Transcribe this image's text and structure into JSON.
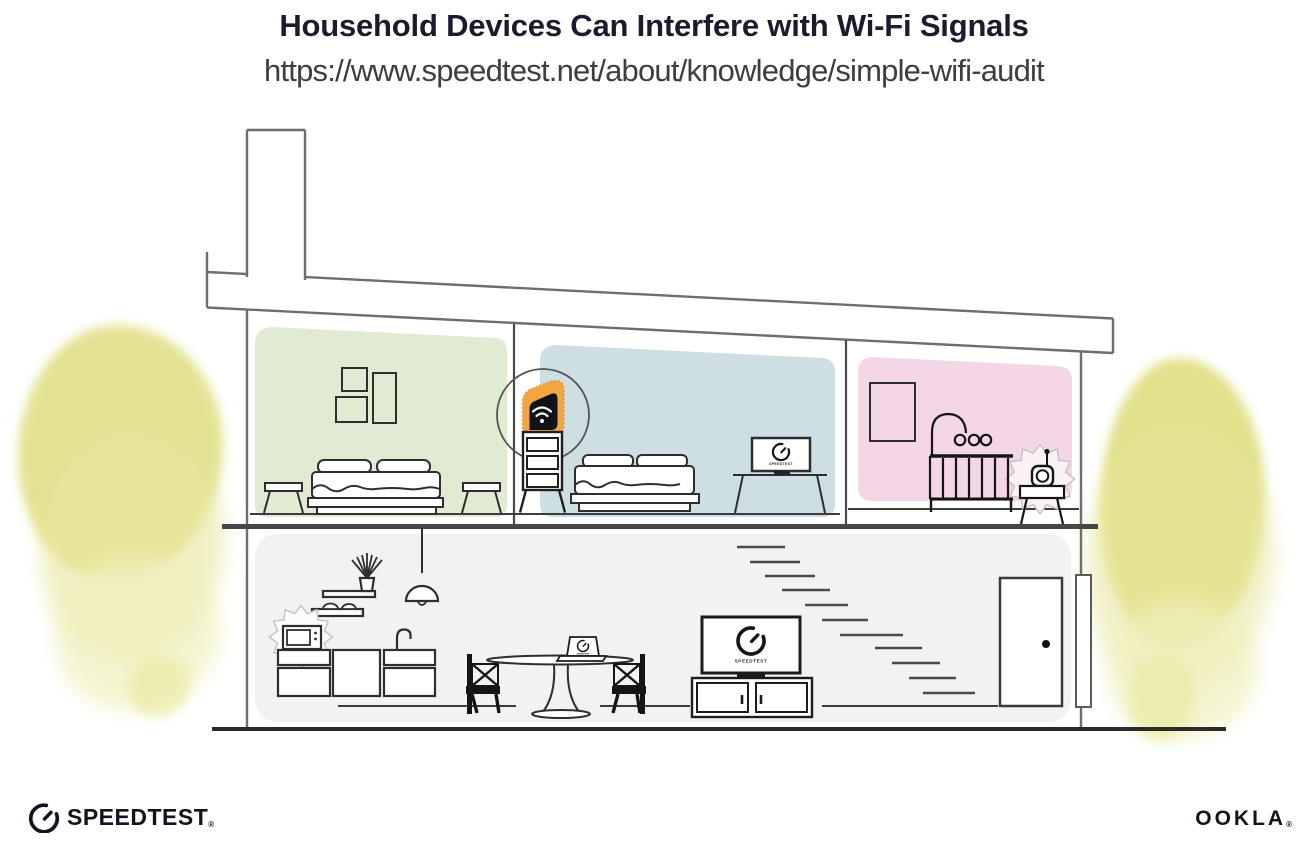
{
  "header": {
    "title": "Household Devices Can Interfere with Wi-Fi Signals",
    "url": "https://www.speedtest.net/about/knowledge/simple-wifi-audit"
  },
  "brand": {
    "speedtest_label": "SPEEDTEST",
    "speedtest_reg": "®",
    "ookla_label": "OOKLA",
    "ookla_reg": "®"
  },
  "device_screens": {
    "bedroom_monitor_label": "SPEEDTEST",
    "living_room_tv_label": "SPEEDTEST",
    "dining_laptop_label": "SPEEDTEST"
  },
  "icons": {
    "router_wifi": "wifi-arcs-icon",
    "speedtest_gauge": "gauge-dial-icon",
    "interference": "burst-star-icon"
  },
  "colors": {
    "title_text": "#1a1b2c",
    "url_text": "#3e3e3e",
    "bedroom_left_wall": "#e1ead2",
    "bedroom_middle_wall": "#cddfe2",
    "nursery_wall": "#f4d7e7",
    "downstairs_wall": "#f2f2f0",
    "router_highlight_orange": "#f3a541",
    "foliage_yellow": "#dddc78",
    "line_art": "#2e2e2e"
  }
}
